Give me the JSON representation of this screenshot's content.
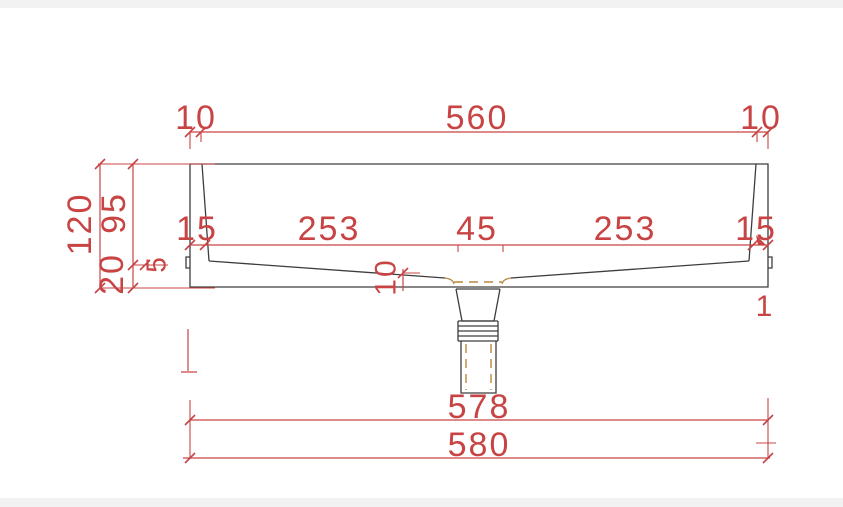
{
  "window": {
    "type": "cad-drawing-view",
    "description": "Technical cross-section drawing of a wash basin with drain tailpiece and dimension annotations"
  },
  "colors": {
    "dimension": "#c84444",
    "outline": "#3d3d3d",
    "hidden": "#b8893b",
    "background": "#ffffff",
    "edge_strip": "#f2f2f2"
  },
  "drawing": {
    "units_note": "",
    "labels": [
      {
        "id": "top-left-10",
        "text": "10",
        "x": 196,
        "y": 129,
        "rot": 0,
        "size": 34
      },
      {
        "id": "top-560",
        "text": "560",
        "x": 477,
        "y": 129,
        "rot": 0,
        "size": 34
      },
      {
        "id": "top-right-10",
        "text": "10",
        "x": 761,
        "y": 129,
        "rot": 0,
        "size": 34
      },
      {
        "id": "left-120",
        "text": "120",
        "x": 80,
        "y": 224,
        "rot": -90,
        "size": 34
      },
      {
        "id": "left-95",
        "text": "95",
        "x": 114,
        "y": 213,
        "rot": -90,
        "size": 34
      },
      {
        "id": "left-20",
        "text": "20",
        "x": 112,
        "y": 274,
        "rot": -90,
        "size": 34
      },
      {
        "id": "left-5",
        "text": "5",
        "x": 156,
        "y": 264,
        "rot": -90,
        "size": 28
      },
      {
        "id": "mid-15-left",
        "text": "15",
        "x": 197,
        "y": 240,
        "rot": 0,
        "size": 34
      },
      {
        "id": "mid-253-left",
        "text": "253",
        "x": 329,
        "y": 240,
        "rot": 0,
        "size": 34
      },
      {
        "id": "mid-45",
        "text": "45",
        "x": 477,
        "y": 240,
        "rot": 0,
        "size": 34
      },
      {
        "id": "mid-253-right",
        "text": "253",
        "x": 625,
        "y": 240,
        "rot": 0,
        "size": 34
      },
      {
        "id": "mid-15-right",
        "text": "15",
        "x": 756,
        "y": 240,
        "rot": 0,
        "size": 34
      },
      {
        "id": "drain-10",
        "text": "10",
        "x": 386,
        "y": 277,
        "rot": -90,
        "size": 30
      },
      {
        "id": "right-stray-1",
        "text": "1",
        "x": 765,
        "y": 316,
        "rot": 0,
        "size": 30
      },
      {
        "id": "bottom-578",
        "text": "578",
        "x": 479,
        "y": 418,
        "rot": 0,
        "size": 34
      },
      {
        "id": "bottom-580",
        "text": "580",
        "x": 479,
        "y": 456,
        "rot": 0,
        "size": 34
      }
    ]
  }
}
